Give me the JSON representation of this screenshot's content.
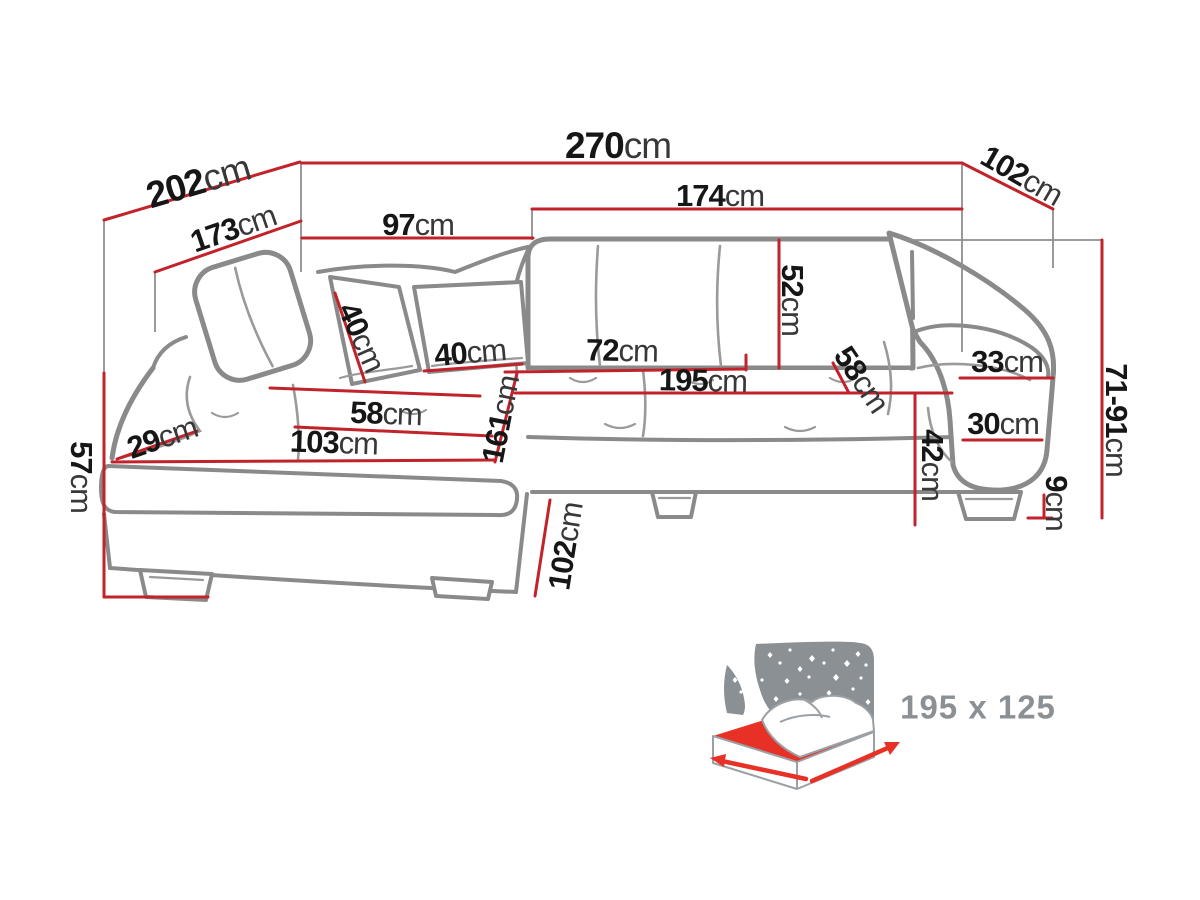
{
  "dims": {
    "d270": {
      "value": "270",
      "unit": "cm"
    },
    "d202": {
      "value": "202",
      "unit": "cm"
    },
    "d173": {
      "value": "173",
      "unit": "cm"
    },
    "d97": {
      "value": "97",
      "unit": "cm"
    },
    "d102_right": {
      "value": "102",
      "unit": "cm"
    },
    "d174": {
      "value": "174",
      "unit": "cm"
    },
    "d52": {
      "value": "52",
      "unit": "cm"
    },
    "d40_left": {
      "value": "40",
      "unit": "cm"
    },
    "d40_right": {
      "value": "40",
      "unit": "cm"
    },
    "d72": {
      "value": "72",
      "unit": "cm"
    },
    "d195": {
      "value": "195",
      "unit": "cm"
    },
    "d58_left": {
      "value": "58",
      "unit": "cm"
    },
    "d58_right": {
      "value": "58",
      "unit": "cm"
    },
    "d33": {
      "value": "33",
      "unit": "cm"
    },
    "d30": {
      "value": "30",
      "unit": "cm"
    },
    "d42": {
      "value": "42",
      "unit": "cm"
    },
    "d29": {
      "value": "29",
      "unit": "cm"
    },
    "d103": {
      "value": "103",
      "unit": "cm"
    },
    "d161": {
      "value": "161",
      "unit": "cm"
    },
    "d57": {
      "value": "57",
      "unit": "cm"
    },
    "d71_91": {
      "value": "71-91",
      "unit": "cm"
    },
    "d9": {
      "value": "9",
      "unit": "cm"
    },
    "d102_chaise": {
      "value": "102",
      "unit": "cm"
    }
  },
  "sleeping_area": {
    "label": "195 x 125"
  },
  "colors": {
    "dimension_line": "#c2232b",
    "sofa_outline": "#8a8a8a",
    "sofa_detail": "#9a9a9a",
    "extension_line": "#8f8f8f",
    "number_color": "#161616",
    "unit_color": "#383838",
    "icon_gray": "#8b9095",
    "icon_red": "#e73127"
  }
}
